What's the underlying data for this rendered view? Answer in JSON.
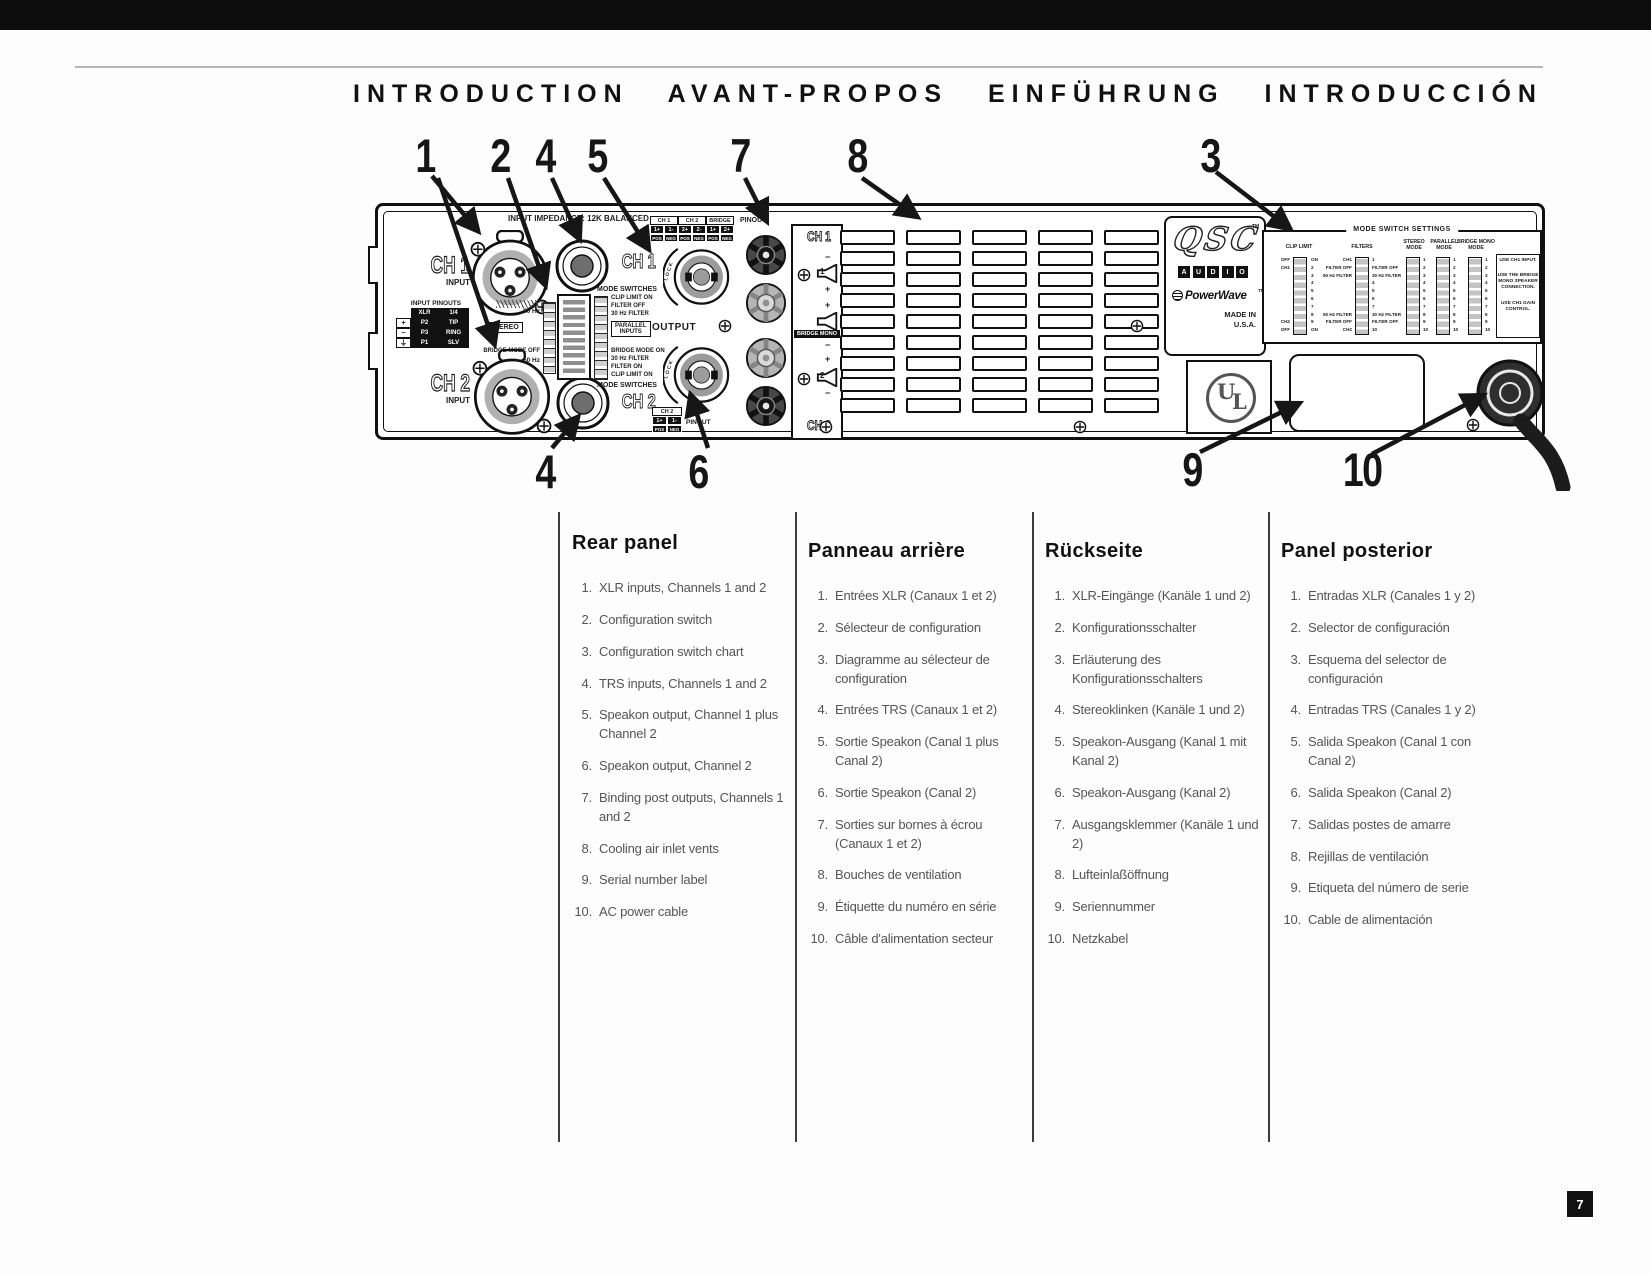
{
  "page": {
    "title": "INTRODUCTION  AVANT-PROPOS  EINFÜHRUNG  INTRODUCCIÓN",
    "page_number": "7"
  },
  "callouts": {
    "top": [
      "1",
      "2",
      "4",
      "5",
      "7",
      "8",
      "3"
    ],
    "bottom": [
      "4",
      "6",
      "9",
      "10"
    ]
  },
  "amp": {
    "impedance": "INPUT IMPEDANCE: 12K BALANCED",
    "ch1": "CH 1",
    "ch1_sub": "INPUT",
    "ch2": "CH 2",
    "ch2_sub": "INPUT",
    "input_pinouts": {
      "title": "INPUT PINOUTS",
      "h": [
        "XLR",
        "1/4"
      ],
      "rows": [
        [
          "+",
          "P2",
          "TIP"
        ],
        [
          "−",
          "P3",
          "RING"
        ],
        [
          "⏚",
          "P1",
          "SLV"
        ]
      ]
    },
    "dip": {
      "hz50_top": "50 Hz",
      "stereo": "STEREO",
      "bridge_off": "BRIDGE MODE OFF",
      "hz50_bottom": "50 Hz",
      "right": [
        "CLIP LIMIT ON",
        "FILTER OFF",
        "30 Hz FILTER",
        "PARALLEL\nINPUTS",
        "BRIDGE MODE ON",
        "30 Hz FILTER",
        "FILTER ON",
        "CLIP LIMIT ON"
      ]
    },
    "mode_sw": "MODE SWITCHES",
    "ch1_big": "CH 1",
    "ch2_big": "CH 2",
    "out_table": {
      "h": [
        "CH 1",
        "CH 2",
        "BRIDGE"
      ],
      "v": [
        "1+",
        "1-",
        "2+",
        "2-",
        "1+",
        "2+"
      ],
      "p": [
        "POS",
        "NEG",
        "POS",
        "NEG",
        "POS",
        "NEG"
      ]
    },
    "pinout": "PINOUT",
    "output": "OUTPUT",
    "lock": "LOCK",
    "ch2_table": {
      "h": "CH 2",
      "v": [
        "1+",
        "1-"
      ],
      "p": [
        "POS",
        "NEG"
      ]
    },
    "posts": {
      "ch1": "CH 1",
      "n1": "1",
      "bridge": "BRIDGE MONO",
      "n2": "2",
      "ch2": "CH 2",
      "plus": "+",
      "minus": "−"
    },
    "logo": {
      "qsc": "QSC",
      "tm": "TM",
      "audio": [
        "A",
        "U",
        "D",
        "I",
        "O"
      ],
      "pw": "PowerWave",
      "madein": "MADE IN",
      "usa": "U.S.A."
    },
    "ul": {
      "u": "U",
      "l": "L"
    },
    "chart": {
      "title": "MODE SWITCH SETTINGS",
      "clip_label": "CLIP LIMIT",
      "clip_left": "OFF\nCH1\n\n\n\n\n\n\nCH2\nOFF",
      "clip_right": "ON\n2\n3\n4\n5\n6\n7\n8\n9\nON",
      "filters_label": "FILTERS",
      "filters_left": "CH1\nFILTER OFF\n50 Hz FILTER\n\n\n\n\n50 Hz FILTER\nFILTER OFF\nCH2",
      "filters_right": "1\nFILTER OFF\n30 Hz FILTER\n4\n5\n6\n7\n30 Hz FILTER\nFILTER OFF\n10",
      "stereo_label": "STEREO\nMODE",
      "parallel_label": "PARALLEL\nMODE",
      "bridge_label": "BRIDGE MONO\nMODE",
      "nums": "1\n2\n3\n4\n5\n6\n7\n8\n9\n10",
      "notes": [
        "USE CH1 INPUT.",
        "USE THE BRIDGE MONO SPEAKER CONNECTION.",
        "USE CH1 GAIN CONTROL."
      ]
    }
  },
  "columns": [
    {
      "heading": "Rear panel",
      "items": [
        {
          "n": "1.",
          "t": "XLR inputs, Channels 1 and 2"
        },
        {
          "n": "2.",
          "t": "Configuration switch"
        },
        {
          "n": "3.",
          "t": "Configuration switch chart"
        },
        {
          "n": "4.",
          "t": "TRS inputs, Channels 1 and 2"
        },
        {
          "n": "5.",
          "t": "Speakon output, Channel 1 plus Channel 2"
        },
        {
          "n": "6.",
          "t": "Speakon output, Channel 2"
        },
        {
          "n": "7.",
          "t": "Binding post outputs, Channels 1 and 2"
        },
        {
          "n": "8.",
          "t": "Cooling air inlet vents"
        },
        {
          "n": "9.",
          "t": "Serial number label"
        },
        {
          "n": "10.",
          "t": "AC power cable"
        }
      ]
    },
    {
      "heading": "Panneau arrière",
      "items": [
        {
          "n": "1.",
          "t": "Entrées XLR (Canaux 1 et 2)"
        },
        {
          "n": "2.",
          "t": "Sélecteur de configuration"
        },
        {
          "n": "3.",
          "t": "Diagramme au sélecteur de configuration"
        },
        {
          "n": "4.",
          "t": "Entrées TRS (Canaux 1 et 2)"
        },
        {
          "n": "5.",
          "t": "Sortie Speakon (Canal 1 plus Canal 2)"
        },
        {
          "n": "6.",
          "t": "Sortie Speakon (Canal 2)"
        },
        {
          "n": "7.",
          "t": "Sorties sur bornes à écrou (Canaux 1 et 2)"
        },
        {
          "n": "8.",
          "t": "Bouches de ventilation"
        },
        {
          "n": "9.",
          "t": "Étiquette du numéro en série"
        },
        {
          "n": "10.",
          "t": "Câble d'alimentation secteur"
        }
      ]
    },
    {
      "heading": "Rückseite",
      "items": [
        {
          "n": "1.",
          "t": "XLR-Eingänge (Kanäle 1 und 2)"
        },
        {
          "n": "2.",
          "t": "Konfigurationsschalter"
        },
        {
          "n": "3.",
          "t": "Erläuterung des Konfigurationsschalters"
        },
        {
          "n": "4.",
          "t": "Stereoklinken (Kanäle 1 und 2)"
        },
        {
          "n": "5.",
          "t": "Speakon-Ausgang (Kanal 1 mit Kanal 2)"
        },
        {
          "n": "6.",
          "t": "Speakon-Ausgang (Kanal 2)"
        },
        {
          "n": "7.",
          "t": "Ausgangsklemmer (Kanäle 1 und 2)"
        },
        {
          "n": "8.",
          "t": "Lufteinlaßöffnung"
        },
        {
          "n": "9.",
          "t": "Seriennummer"
        },
        {
          "n": "10.",
          "t": "Netzkabel"
        }
      ]
    },
    {
      "heading": "Panel posterior",
      "items": [
        {
          "n": "1.",
          "t": "Entradas XLR (Canales 1 y 2)"
        },
        {
          "n": "2.",
          "t": "Selector de configuración"
        },
        {
          "n": "3.",
          "t": "Esquema del selector de configuración"
        },
        {
          "n": "4.",
          "t": "Entradas TRS (Canales 1 y 2)"
        },
        {
          "n": "5.",
          "t": "Salida Speakon (Canal 1 con Canal 2)"
        },
        {
          "n": "6.",
          "t": "Salida Speakon (Canal 2)"
        },
        {
          "n": "7.",
          "t": "Salidas postes de amarre"
        },
        {
          "n": "8.",
          "t": "Rejillas de ventilación"
        },
        {
          "n": "9.",
          "t": "Etiqueta del número de serie"
        },
        {
          "n": "10.",
          "t": "Cable de alimentación"
        }
      ]
    }
  ]
}
